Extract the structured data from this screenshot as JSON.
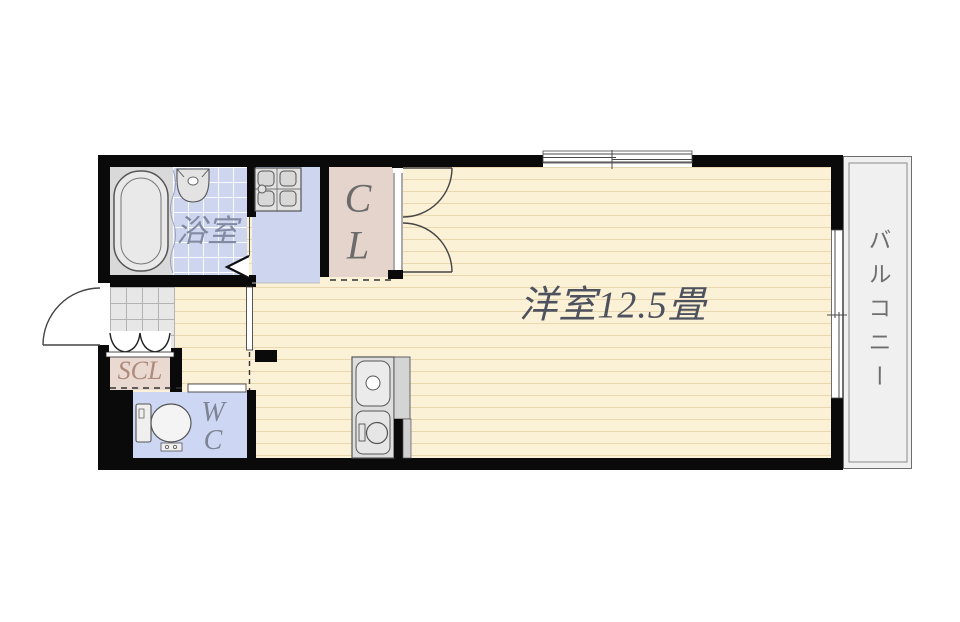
{
  "plan_type": "floor-plan",
  "rooms": {
    "bathroom": {
      "label": "浴室"
    },
    "closet": {
      "label_lines": [
        "C",
        "L"
      ]
    },
    "main_room": {
      "label": "洋室12.5畳"
    },
    "shoe_closet": {
      "label": "SCL"
    },
    "toilet": {
      "label_lines": [
        "W",
        "C"
      ]
    },
    "balcony": {
      "label": "バルコニー"
    }
  },
  "fixtures": [
    "bathtub",
    "washbasin",
    "stove",
    "toilet",
    "kitchen-sink-unit"
  ],
  "colors": {
    "wall": "#0a0a0a",
    "floor_wood": "#faf1d6",
    "floor_wood_line": "#e9d7b0",
    "floor_wet_blue": "#cdd5ef",
    "floor_closet_pink": "#e5d4cc",
    "floor_entry_gray": "#e7e7e7",
    "floor_balcony_gray": "#f0f0f0",
    "label_main": "#4e525e",
    "label_bath": "#8289a3",
    "label_closet": "#6b6b6b",
    "label_scl": "#ae8a7b",
    "label_wc": "#7e8494",
    "label_balcony": "#6e6e6e"
  }
}
